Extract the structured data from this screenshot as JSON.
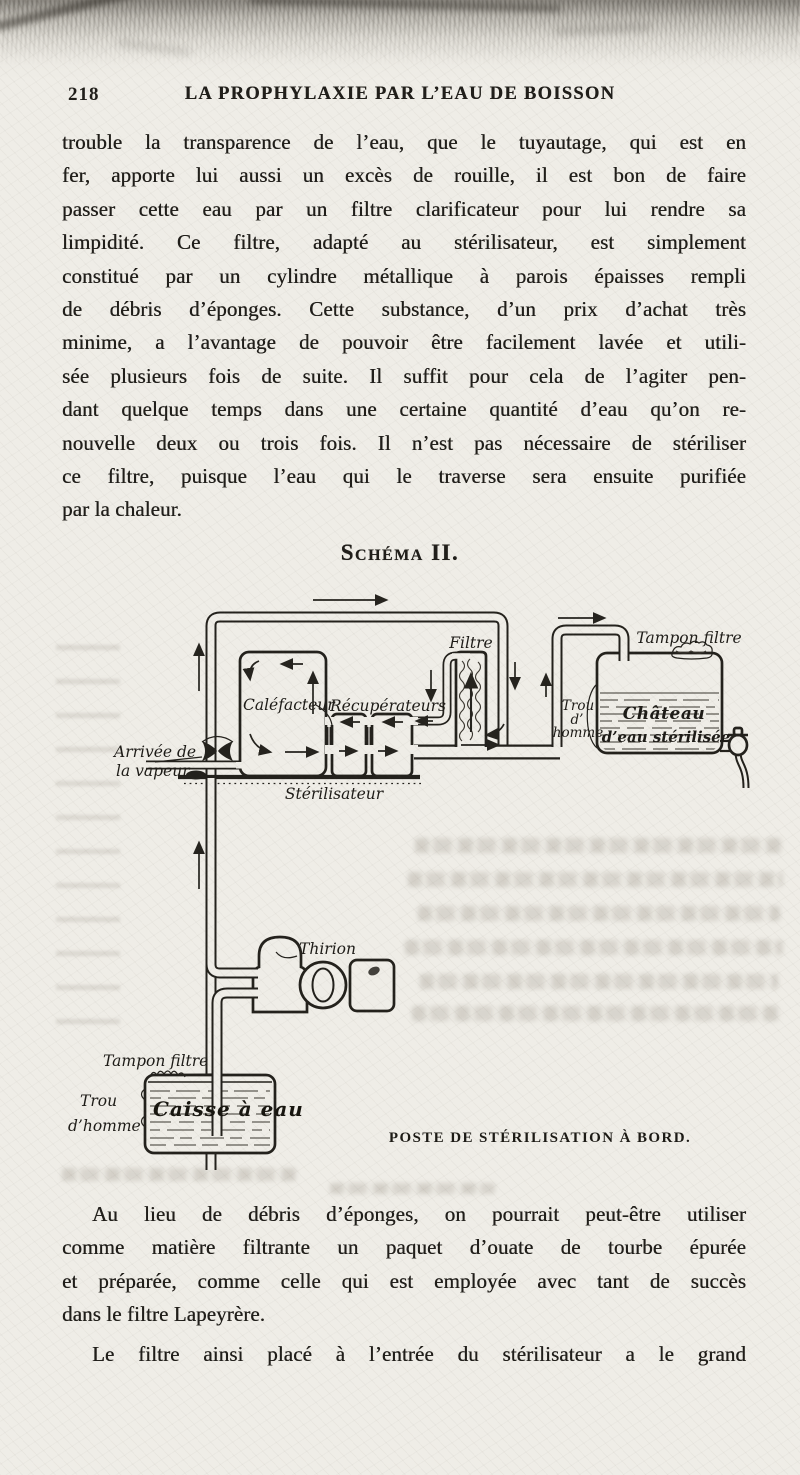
{
  "page": {
    "number": "218",
    "running_title": "LA PROPHYLAXIE PAR L’EAU DE BOISSON"
  },
  "colors": {
    "paper": "#efede7",
    "ink": "#201e1a"
  },
  "paragraph1": {
    "lines": [
      "trouble la transparence de l’eau, que le tuyautage, qui est en",
      "fer, apporte lui aussi un excès de rouille, il est bon de faire",
      "passer cette eau par un filtre clarificateur pour lui rendre sa",
      "limpidité. Ce filtre, adapté au stérilisateur, est simplement",
      "constitué par un cylindre métallique à parois épaisses rempli",
      "de débris d’éponges. Cette substance, d’un prix d’achat très",
      "minime, a l’avantage de pouvoir être facilement lavée et utili-",
      "sée plusieurs fois de suite. Il suffit pour cela de l’agiter pen-",
      "dant quelque temps dans une certaine quantité d’eau qu’on re-",
      "nouvelle deux ou trois fois. Il n’est pas nécessaire de stériliser",
      "ce filtre, puisque l’eau qui le traverse sera ensuite purifiée",
      "par la chaleur."
    ]
  },
  "schema_heading": "Schéma II.",
  "diagram": {
    "caption": "POSTE DE STÉRILISATION À BORD.",
    "labels": {
      "arrivee_line1": "Arrivée de",
      "arrivee_line2": "la vapeur",
      "calefacteur": "Caléfacteur",
      "recuperateurs": "Récupérateurs",
      "sterilisateur": "Stérilisateur",
      "filtre": "Filtre",
      "tampon_filtre_haut": "Tampon filtre",
      "trou_homme_haut_1": "Trou",
      "trou_homme_haut_2": "d’",
      "trou_homme_haut_3": "homme",
      "chateau_1": "Château",
      "chateau_2": "d’eau stérilisée",
      "thirion": "Thirion",
      "tampon_filtre_bas": "Tampon filtre",
      "trou_homme_bas_1": "Trou",
      "trou_homme_bas_2": "d’homme",
      "caisse": "Caisse à eau"
    }
  },
  "paragraph2": {
    "lines": [
      "Au lieu de débris d’éponges, on pourrait peut-être utiliser",
      "comme matière filtrante un paquet d’ouate de tourbe épurée",
      "et préparée, comme celle qui est employée avec tant de succès",
      "dans le filtre Lapeyrère."
    ]
  },
  "paragraph3": {
    "lines": [
      "Le filtre ainsi placé à l’entrée du stérilisateur a le grand"
    ]
  }
}
